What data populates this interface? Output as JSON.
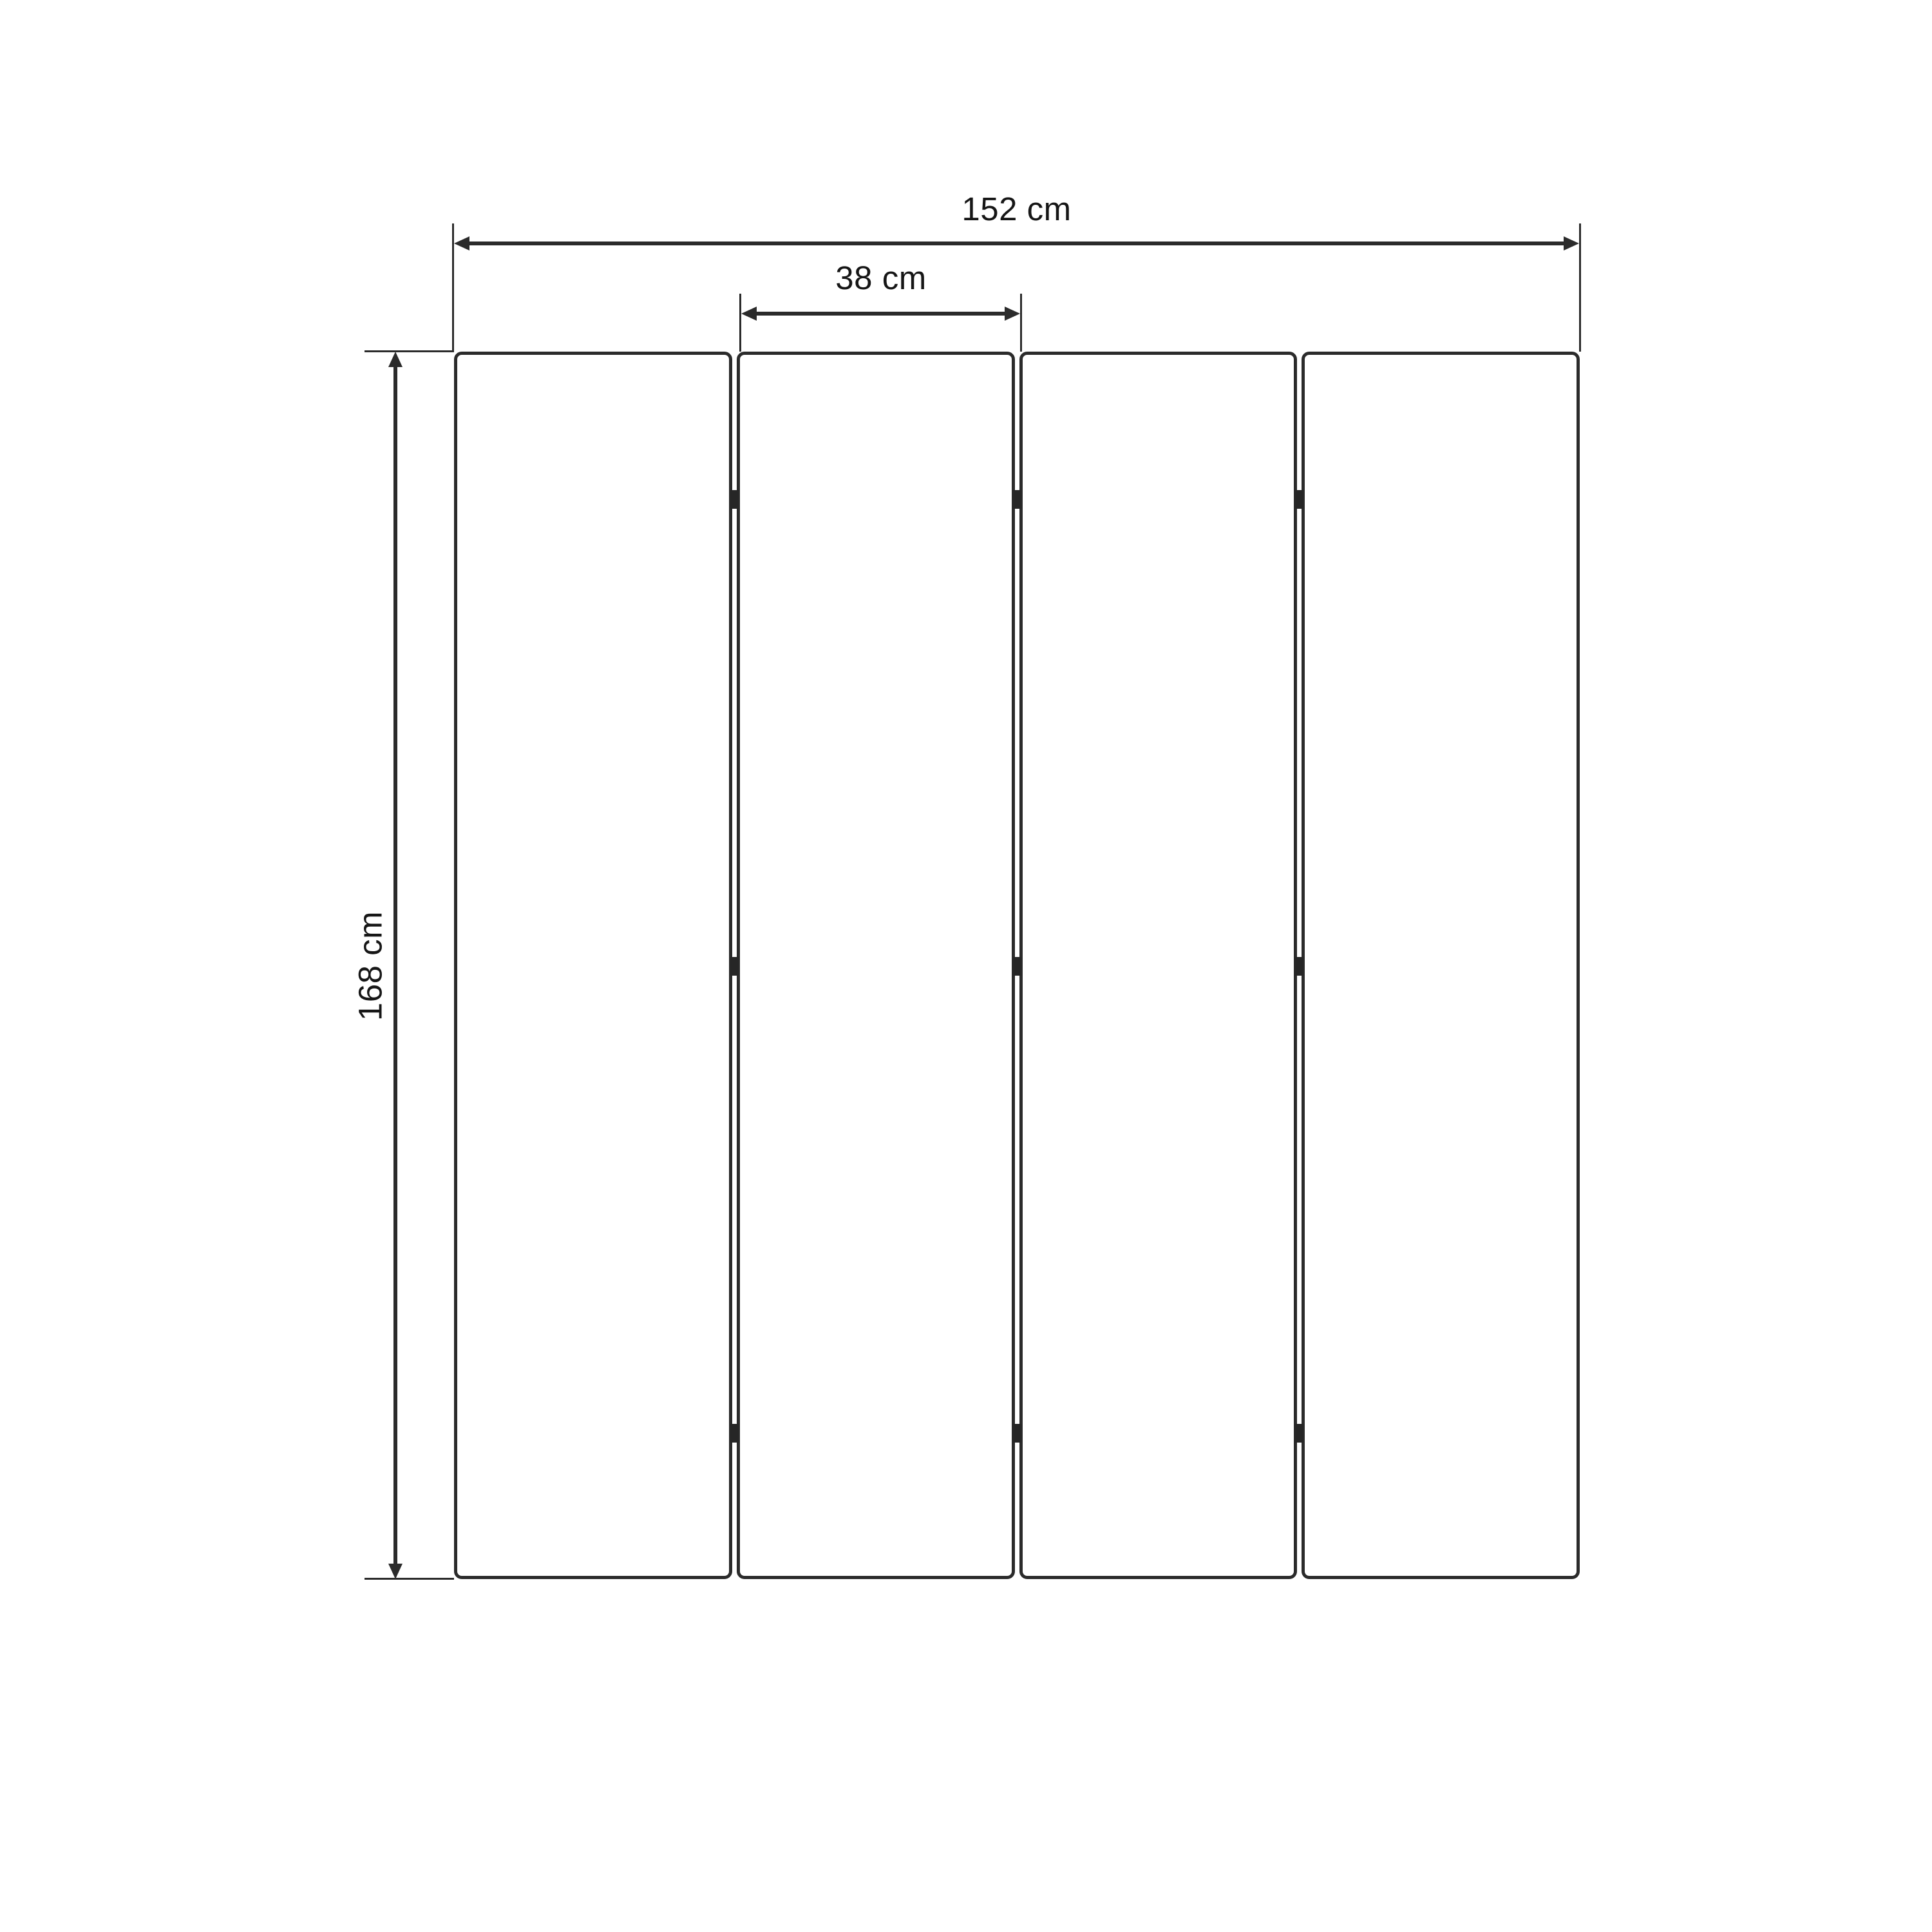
{
  "diagram": {
    "type": "dimension-drawing",
    "subject": "four-panel folding screen front view",
    "panel_count": 4,
    "hinge_rows": 3,
    "labels": {
      "total_width": "152 cm",
      "panel_width": "38 cm",
      "height": "168 cm"
    },
    "colors": {
      "line": "#2b2b2b",
      "background": "#ffffff",
      "text": "#161616"
    }
  }
}
